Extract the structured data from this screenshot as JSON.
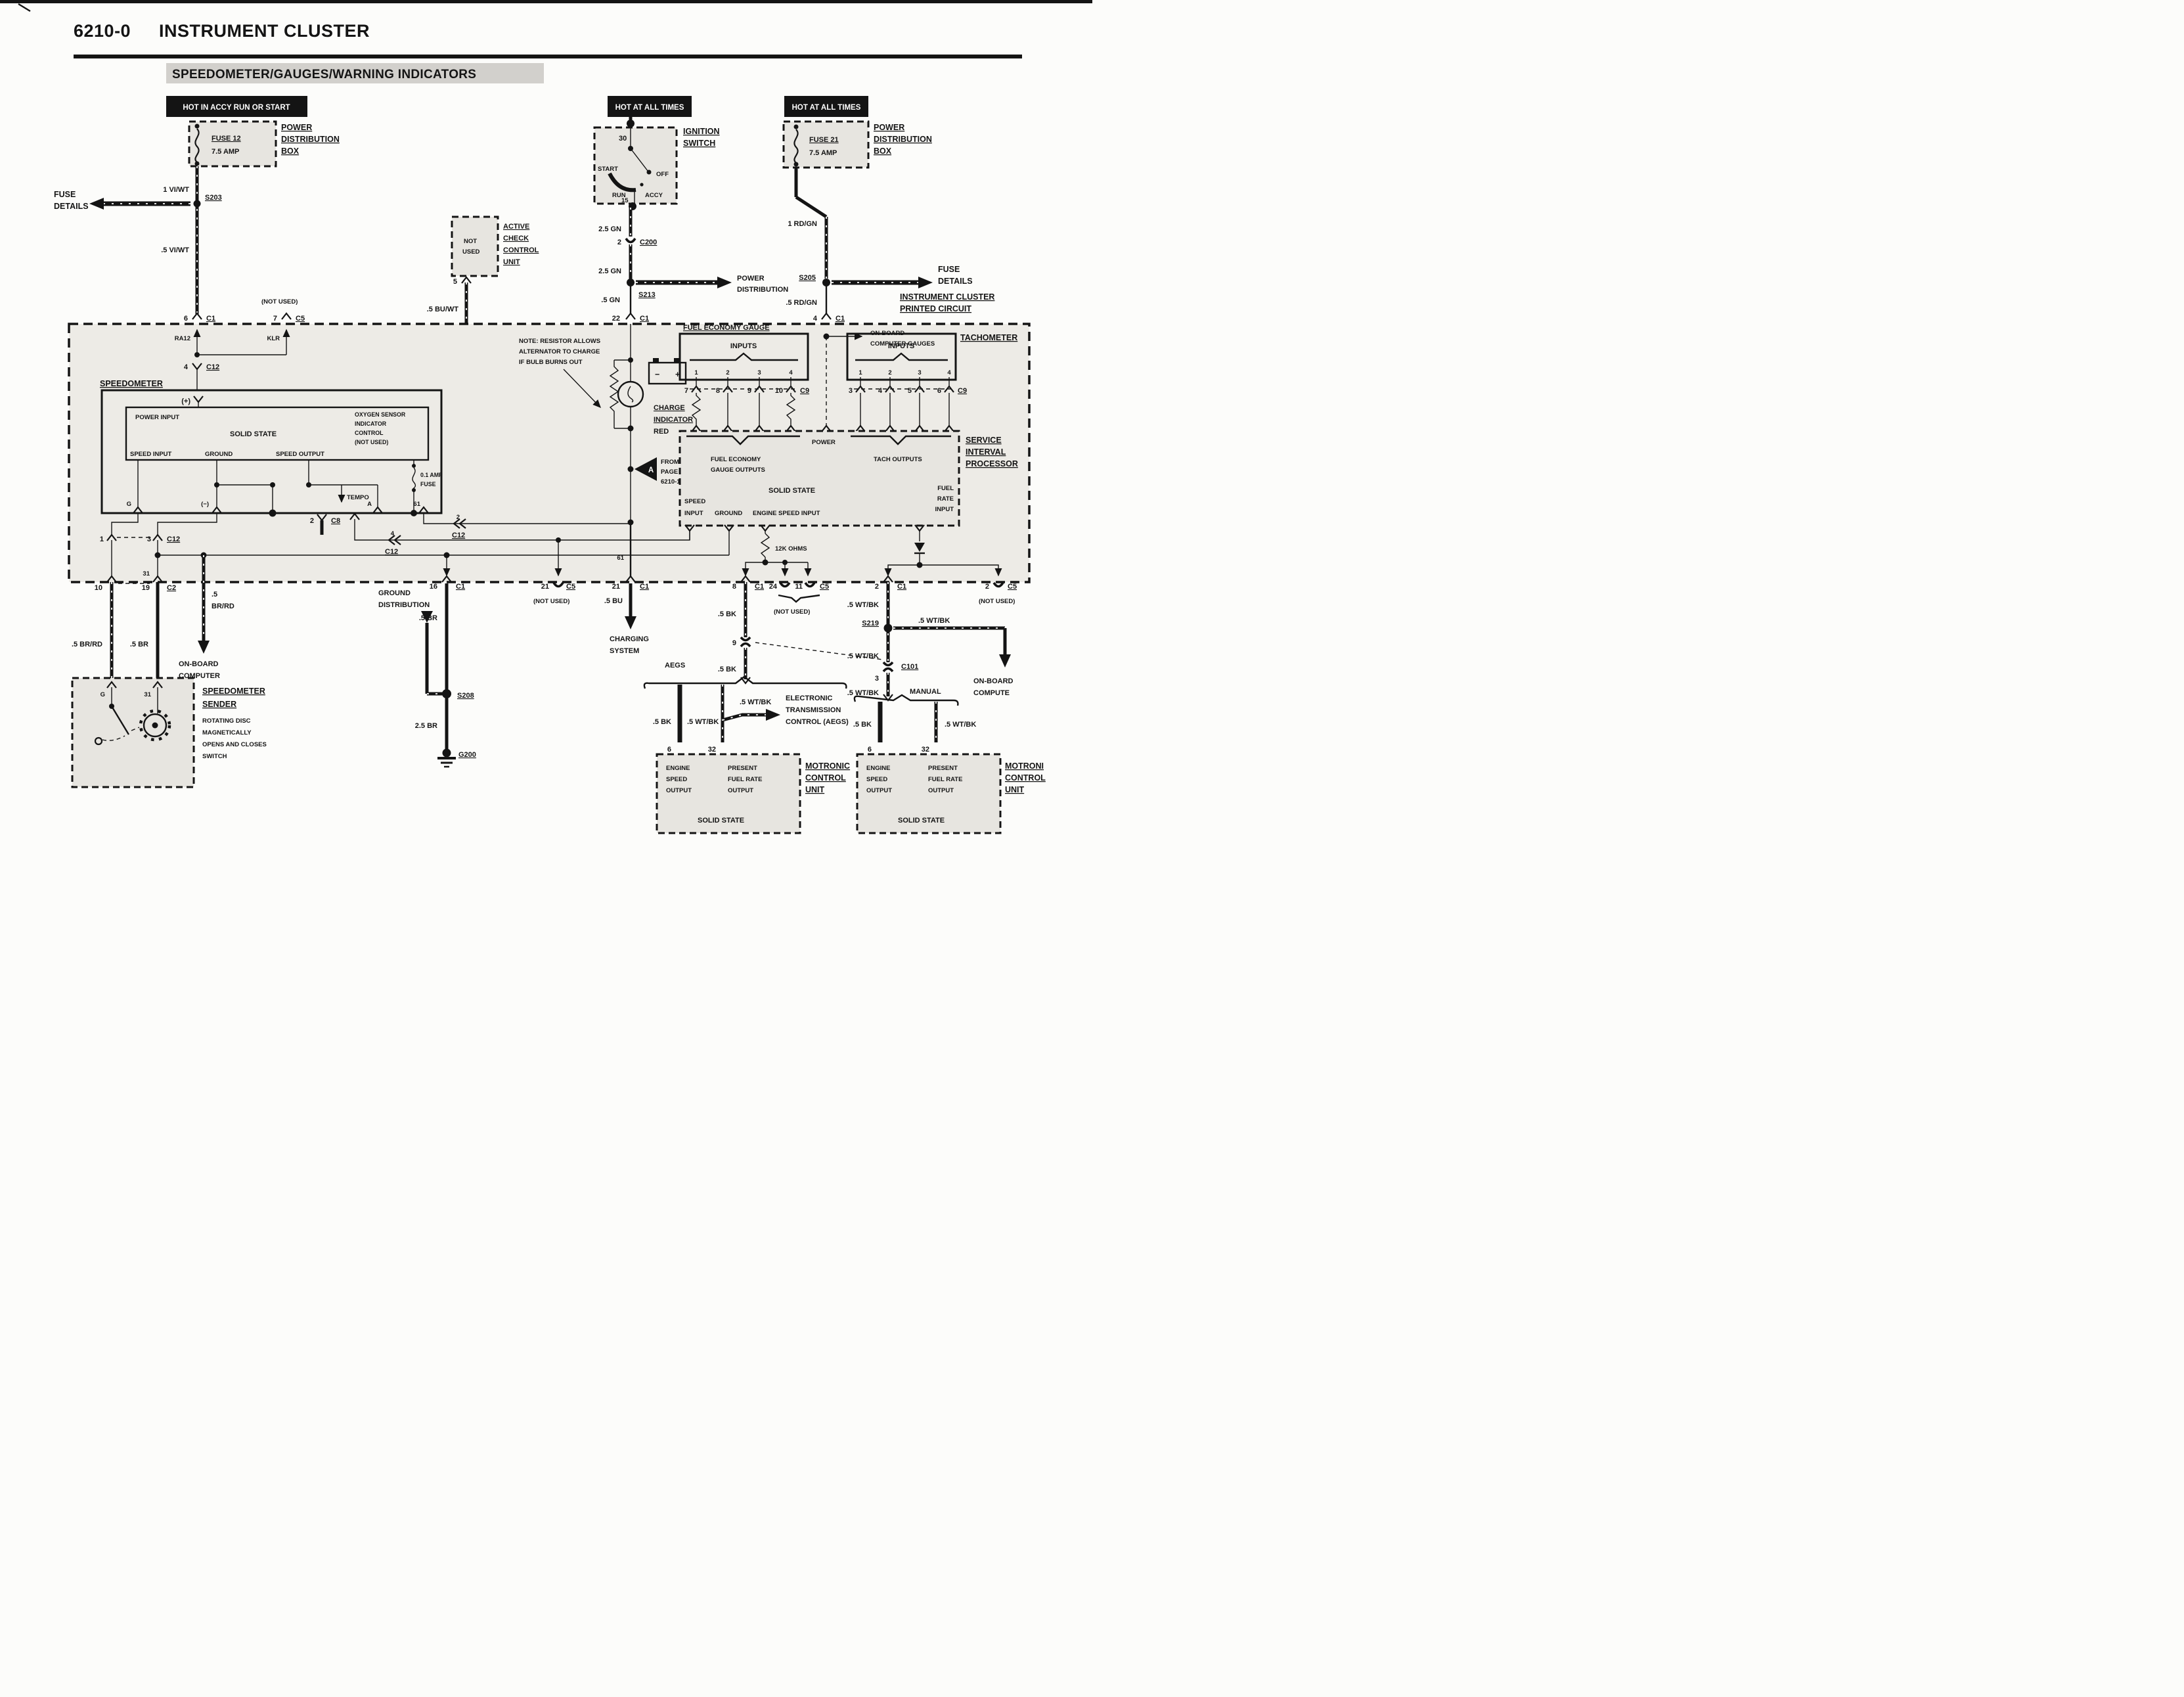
{
  "header": {
    "code": "6210-0",
    "title": "INSTRUMENT CLUSTER",
    "subtitle": "SPEEDOMETER/GAUGES/WARNING INDICATORS"
  },
  "banners": {
    "accy": "HOT IN ACCY RUN OR START",
    "all1": "HOT AT ALL TIMES",
    "all2": "HOT AT ALL TIMES"
  },
  "fuse12": {
    "name": "FUSE 12",
    "amp": "7.5 AMP"
  },
  "fuse21": {
    "name": "FUSE 21",
    "amp": "7.5 AMP"
  },
  "pdb": [
    "POWER",
    "DISTRIBUTION",
    "BOX"
  ],
  "fuse_details": [
    "FUSE",
    "DETAILS"
  ],
  "power_dist": [
    "POWER",
    "DISTRIBUTION"
  ],
  "ignition": {
    "label": [
      "IGNITION",
      "SWITCH"
    ],
    "t30": "30",
    "t15": "15",
    "start": "START",
    "run": "RUN",
    "accy": "ACCY",
    "off": "OFF"
  },
  "acc_unit": {
    "not": "NOT",
    "used": "USED",
    "label": [
      "ACTIVE",
      "CHECK",
      "CONTROL",
      "UNIT"
    ]
  },
  "splices": {
    "s203": "S203",
    "s205": "S205",
    "s213": "S213",
    "s208": "S208",
    "s219": "S219",
    "g200": "G200"
  },
  "connectors": {
    "c1": "C1",
    "c2": "C2",
    "c3": "C3",
    "c5": "C5",
    "c8": "C8",
    "c9": "C9",
    "c12": "C12",
    "c101": "C101",
    "c200": "C200"
  },
  "pins": {
    "1": "1",
    "2": "2",
    "3": "3",
    "4": "4",
    "5": "5",
    "6": "6",
    "7": "7",
    "8": "8",
    "9": "9",
    "10": "10",
    "11": "11",
    "16": "16",
    "19": "19",
    "21": "21",
    "22": "22",
    "24": "24",
    "31": "31",
    "32": "32",
    "61": "61"
  },
  "wires": {
    "vi1": "1 VI/WT",
    "vi5": ".5 VI/WT",
    "gn25": "2.5 GN",
    "gn5": ".5 GN",
    "rdgn1": "1 RD/GN",
    "rdgn5": ".5 RD/GN",
    "buwt": ".5 BU/WT",
    "bu": ".5 BU",
    "br": ".5 BR",
    "br25": "2.5 BR",
    "brrd": ".5 BR/RD",
    "p5": ".5",
    "brrd2": "BR/RD",
    "bk": ".5 BK",
    "wtbk": ".5 WT/BK",
    "ohms": "12K OHMS"
  },
  "cluster": {
    "label": [
      "INSTRUMENT CLUSTER",
      "PRINTED CIRCUIT"
    ],
    "ra12": "RA12",
    "klr": "KLR"
  },
  "speedometer": {
    "title": "SPEEDOMETER",
    "plus": "(+)",
    "minus": "(−)",
    "power_input": "POWER INPUT",
    "solid_state": "SOLID STATE",
    "oxygen": [
      "OXYGEN SENSOR",
      "INDICATOR",
      "CONTROL",
      "(NOT USED)"
    ],
    "speed_input": "SPEED INPUT",
    "ground": "GROUND",
    "speed_output": "SPEED OUTPUT",
    "tempo": "TEMPO",
    "fuse": [
      "0.1 AMP",
      "FUSE"
    ],
    "g": "G",
    "a": "A"
  },
  "note": [
    "NOTE: RESISTOR ALLOWS",
    "ALTERNATOR TO CHARGE",
    "IF BULB BURNS OUT"
  ],
  "charge": {
    "label": [
      "CHARGE",
      "INDICATOR"
    ],
    "red": "RED",
    "minus": "−",
    "plus": "+"
  },
  "from_page": {
    "a": "A",
    "lines": [
      "FROM",
      "PAGE",
      "6210-1"
    ]
  },
  "charging_system": [
    "CHARGING",
    "SYSTEM"
  ],
  "ground_dist": [
    "GROUND",
    "DISTRIBUTION"
  ],
  "onboard_computer": [
    "ON-BOARD",
    "COMPUTER"
  ],
  "onboard_compute": [
    "ON-BOARD",
    "COMPUTE"
  ],
  "onboard_gauges": [
    "ON-BOARD",
    "COMPUTER GAUGES"
  ],
  "fe_gauge": {
    "title": "FUEL ECONOMY GAUGE",
    "inputs": "INPUTS"
  },
  "tach": {
    "title": "TACHOMETER",
    "inputs": "INPUTS"
  },
  "sip": {
    "label": [
      "SERVICE",
      "INTERVAL",
      "PROCESSOR"
    ],
    "power": "POWER",
    "fe_out": [
      "FUEL ECONOMY",
      "GAUGE OUTPUTS"
    ],
    "tach_out": "TACH OUTPUTS",
    "solid_state": "SOLID STATE",
    "speed": "SPEED",
    "input": "INPUT",
    "ground": "GROUND",
    "engine": "ENGINE SPEED INPUT",
    "fuel": [
      "FUEL",
      "RATE",
      "INPUT"
    ]
  },
  "aegs": {
    "label": "AEGS",
    "manual": "MANUAL",
    "etc": [
      "ELECTRONIC",
      "TRANSMISSION",
      "CONTROL (AEGS)"
    ]
  },
  "motronic": {
    "engine": [
      "ENGINE",
      "SPEED",
      "OUTPUT"
    ],
    "present": [
      "PRESENT",
      "FUEL RATE",
      "OUTPUT"
    ],
    "solid_state": "SOLID STATE",
    "label_left": [
      "MOTRONIC",
      "CONTROL",
      "UNIT"
    ],
    "label_right": [
      "MOTRONI",
      "CONTROL",
      "UNIT"
    ]
  },
  "sender": {
    "label": [
      "SPEEDOMETER",
      "SENDER"
    ],
    "desc": [
      "ROTATING DISC",
      "MAGNETICALLY",
      "OPENS AND CLOSES",
      "SWITCH"
    ],
    "g": "G",
    "n31": "31"
  },
  "not_used": "(NOT USED)"
}
